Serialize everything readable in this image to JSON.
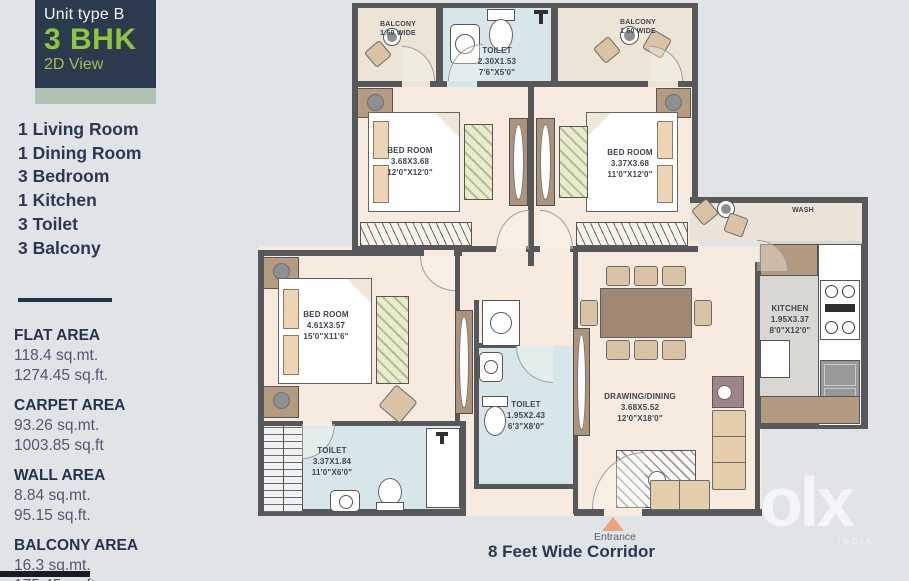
{
  "sidebar": {
    "header": {
      "line1": "Unit type B",
      "line2": "3 BHK",
      "line3": "2D View"
    },
    "room_list": [
      "1 Living Room",
      "1 Dining Room",
      "3 Bedroom",
      "1 Kitchen",
      "3 Toilet",
      "3 Balcony"
    ],
    "areas": [
      {
        "label": "FLAT AREA",
        "sqmt": "118.4 sq.mt.",
        "sqft": "1274.45 sq.ft."
      },
      {
        "label": "CARPET AREA",
        "sqmt": "93.26 sq.mt.",
        "sqft": "1003.85 sq.ft"
      },
      {
        "label": "WALL AREA",
        "sqmt": "8.84 sq.mt.",
        "sqft": "95.15 sq.ft."
      },
      {
        "label": "BALCONY AREA",
        "sqmt": "16.3 sq.mt.",
        "sqft": "175.45 sq.ft"
      }
    ]
  },
  "plan": {
    "rooms": {
      "balcony_left": {
        "name": "BALCONY",
        "l1": "1.60 WIDE"
      },
      "toilet_top": {
        "name": "TOILET",
        "l1": "2.30X1.53",
        "l2": "7'6\"X5'0\""
      },
      "balcony_right": {
        "name": "BALCONY",
        "l1": "1.60 WIDE"
      },
      "bedroom_1": {
        "name": "BED ROOM",
        "l1": "3.68X3.68",
        "l2": "12'0\"X12'0\""
      },
      "bedroom_2": {
        "name": "BED ROOM",
        "l1": "3.37X3.68",
        "l2": "11'0\"X12'0\""
      },
      "bedroom_3": {
        "name": "BED ROOM",
        "l1": "4.61X3.57",
        "l2": "15'0\"X11'6\""
      },
      "wash": {
        "name": "WASH"
      },
      "kitchen": {
        "name": "KITCHEN",
        "l1": "1.95X3.37",
        "l2": "8'0\"X12'0\""
      },
      "toilet_mid": {
        "name": "TOILET",
        "l1": "1.95X2.43",
        "l2": "6'3\"X8'0\""
      },
      "toilet_bottom": {
        "name": "TOILET",
        "l1": "3.37X1.84",
        "l2": "11'0\"X6'0\""
      },
      "drawing_dining": {
        "name": "DRAWING/DINING",
        "l1": "3.68X5.52",
        "l2": "12'0\"X18'0\""
      }
    },
    "entrance_label": "Entrance",
    "corridor_label": "8 Feet Wide Corridor"
  },
  "watermark": {
    "brand": "olx",
    "region": "INDIA"
  },
  "colors": {
    "accent_green": "#8ec63f",
    "header_navy": "#2c3a4e",
    "wall": "#57585a",
    "room_cream": "#f7ebdf",
    "toilet_blue": "#d7e7e9",
    "kitchen_grey": "#d8d7d2",
    "wardrobe_green": "#e7edca",
    "furniture_tan": "#d9c3a4",
    "entrance_orange": "#f0a27b"
  }
}
